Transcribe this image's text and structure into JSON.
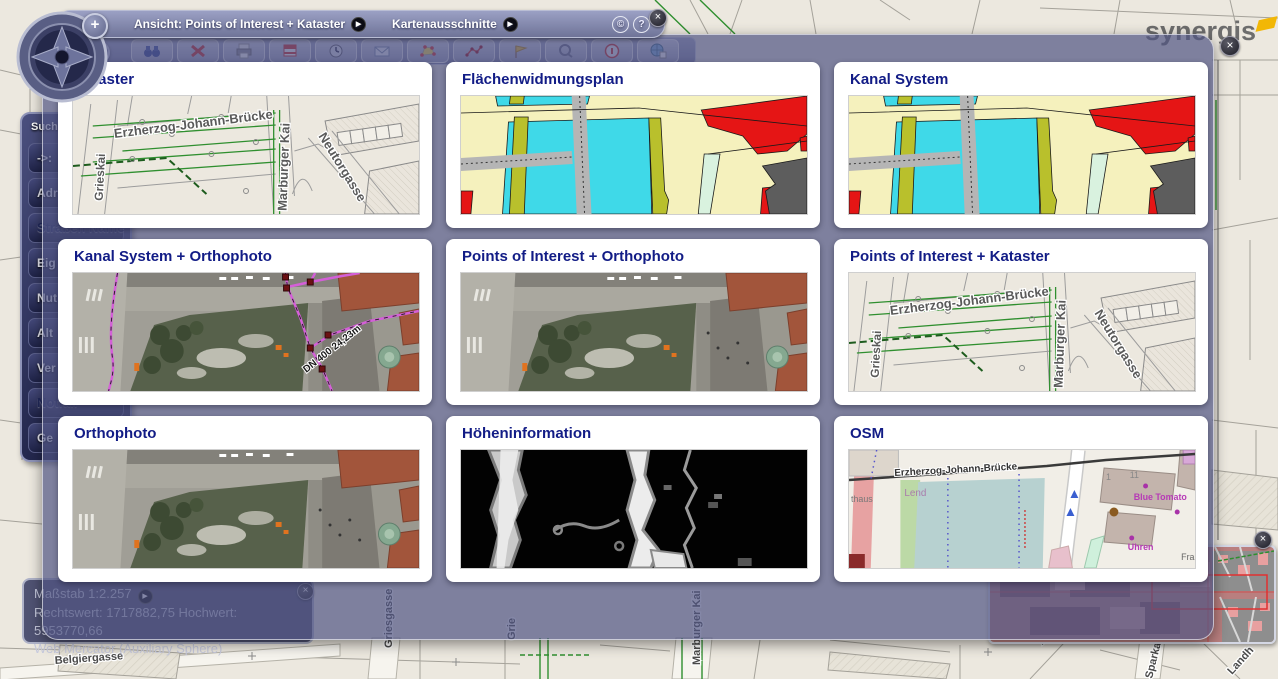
{
  "controls": {
    "close": "×",
    "play": "▶",
    "zoom_in": "+",
    "zoom_out": "−",
    "copyright": "©",
    "help": "?"
  },
  "header": {
    "view_button": "Ansicht: Points of Interest + Kataster",
    "sections_button": "Kartenausschnitte"
  },
  "brand": {
    "name": "synergis",
    "accent_color": "#f2b705"
  },
  "toolbar_icons": [
    "binoculars-search",
    "delete",
    "print",
    "banner-flag",
    "clock",
    "mail-search",
    "polygon-select",
    "measure-path",
    "marker-flag",
    "magnifier",
    "info",
    "globe-document"
  ],
  "sidebar": {
    "title": "Suche",
    "items": [
      "->:",
      "Adr",
      "Straßen Name",
      "Eig",
      "Nut",
      "Alt",
      "Ver",
      "Notfall",
      "Ge"
    ]
  },
  "status": {
    "scale": "Maßstab 1:2.257",
    "coords": "Rechtswert: 1717882,75 Hochwert: 5953770,66",
    "projection": "Web Mercator (Auxiliary Sphere)"
  },
  "tiles": [
    {
      "title": "Kataster",
      "labels": {
        "bridge": "Erzherzog-Johann-Brücke",
        "left": "Grieskai",
        "right": "Marburger Kai",
        "diag": "Neutorgasse"
      }
    },
    {
      "title": "Flächenwidmungsplan"
    },
    {
      "title": "Kanal System"
    },
    {
      "title": "Kanal System + Orthophoto",
      "labels": {
        "pipe": "DN 400  24,23m"
      }
    },
    {
      "title": "Points of Interest + Orthophoto"
    },
    {
      "title": "Points of Interest + Kataster",
      "labels": {
        "bridge": "Erzherzog-Johann-Brücke",
        "left": "Grieskai",
        "right": "Marburger Kai",
        "diag": "Neutorgasse"
      }
    },
    {
      "title": "Orthophoto"
    },
    {
      "title": "Höheninformation"
    },
    {
      "title": "OSM",
      "labels": {
        "bridge": "Erzherzog-Johann-Brücke",
        "district": "Lend",
        "shop": "Blue Tomato",
        "shop2": "Uhren",
        "cut_left": "thaus",
        "num1": "1",
        "num2": "11",
        "cut_right": "Fra"
      }
    }
  ],
  "map_labels": {
    "b1": "Belgiergasse",
    "b2": "Griesgasse",
    "b3": "Grie",
    "b4": "Marburger Kai",
    "b5": "Albrechtgasse",
    "b6": "Sparkassenplatz",
    "b7": "Landh"
  }
}
